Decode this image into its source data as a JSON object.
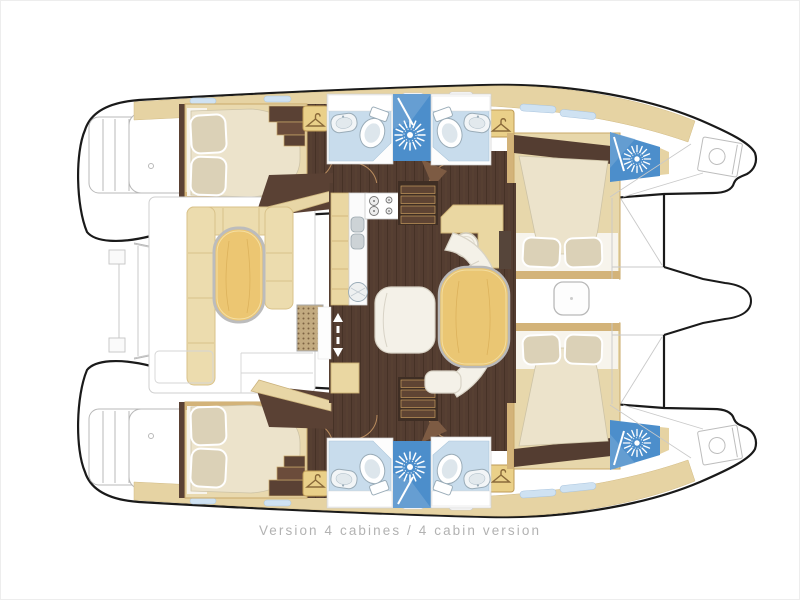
{
  "caption": {
    "text": "Version 4 cabines / 4 cabin version"
  },
  "plan": {
    "vessel_type": "catamaran deck plan, top view",
    "cabin_count": 4,
    "depicted_rooms": {
      "aft_cabin_upper": "double berth, two pillows, foot tapering inboard",
      "aft_cabin_lower": "double berth, two pillows, foot tapering inboard",
      "forward_cabin_upper": "transverse double berth, two pillows inboard",
      "forward_cabin_lower": "transverse double berth, two pillows inboard",
      "bathrooms": "4 heads with toilet and washbasin on light blue floor",
      "showers": "4 shower stalls marked with white jet starburst on blue",
      "saloon": "dark wood floor, galley with cooktop, twin sinks and round sink, companionway stairs, chart desk with round stool, oval dining table, curved settee, armchair",
      "cockpit": "white sole, U-shaped bench around oval table, slatted deck grate",
      "foredeck": "trampoline lacing lines, anchor lockers with windlass, bowsprit between bows",
      "sterns": "transom swim steps"
    }
  },
  "icons": {
    "shower_jet": "white starburst on blue square",
    "wardrobe": "clothes hanger in beige locker",
    "companionway": "white up and down arrows on dark floor",
    "cooktop": "two large and two small burners",
    "deck_hatch": "rounded square with centre dot"
  },
  "colors": {
    "hull_outline": "#1a1a1a",
    "deck_outline_gray": "#c5c5c5",
    "deck_trim_beige": "#e6d3a3",
    "cabin_wood": "#e9d9ae",
    "wood_rim": "#d3b379",
    "floor_dark_wood": "#543d31",
    "bathroom_floor_blue": "#c8dcec",
    "shower_blue": "#4c8ecb",
    "mattress_cream": "#ece3cb",
    "pillow": "#dbd1b7",
    "bench_beige": "#ecdcae",
    "table_wood": "#ecc672",
    "grate_tan": "#c2aa80",
    "caption_gray": "#b2b2b2"
  }
}
